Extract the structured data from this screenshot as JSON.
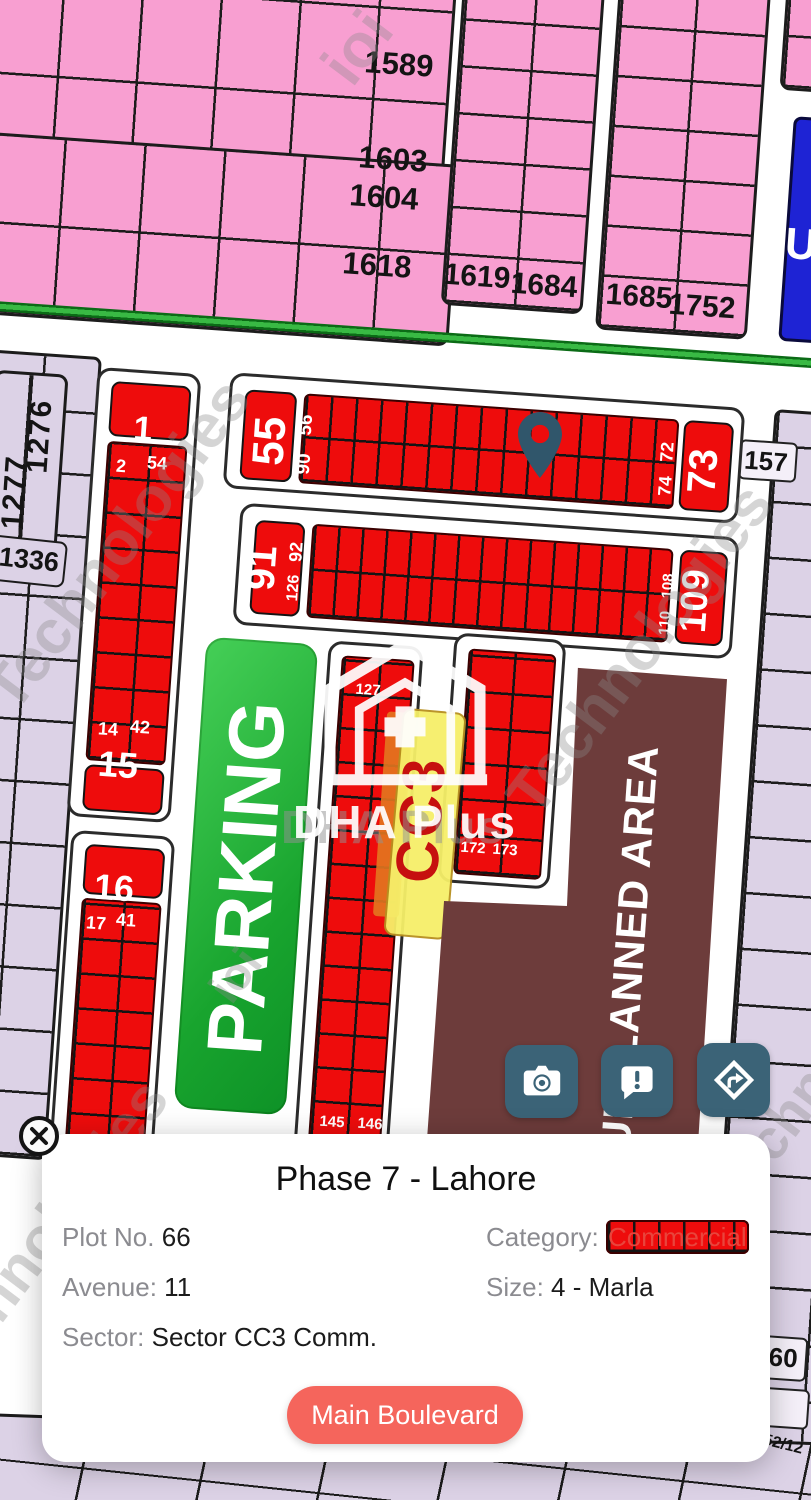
{
  "map": {
    "name": "DHA Phase 7 Lahore plot map",
    "labels": [
      {
        "t": "1589",
        "x": 399,
        "y": 64,
        "r": 4,
        "s": 31
      },
      {
        "t": "1603",
        "x": 393,
        "y": 159,
        "r": 4,
        "s": 31
      },
      {
        "t": "1604",
        "x": 384,
        "y": 197,
        "r": 4,
        "s": 31
      },
      {
        "t": "1618",
        "x": 377,
        "y": 265,
        "r": 4,
        "s": 31
      },
      {
        "t": "1619",
        "x": 477,
        "y": 277,
        "r": 4,
        "s": 30
      },
      {
        "t": "1684",
        "x": 544,
        "y": 286,
        "r": 4,
        "s": 30
      },
      {
        "t": "1685",
        "x": 639,
        "y": 297,
        "r": 4,
        "s": 30
      },
      {
        "t": "1752",
        "x": 702,
        "y": 307,
        "r": 4,
        "s": 30
      },
      {
        "t": "U",
        "x": 801,
        "y": 245,
        "r": 4,
        "s": 44,
        "c": "#ffffff"
      },
      {
        "t": "157",
        "x": 766,
        "y": 461,
        "r": 4,
        "s": 26
      },
      {
        "t": "160",
        "x": 776,
        "y": 1357,
        "r": 4,
        "s": 26
      },
      {
        "t": "52/12",
        "x": 783,
        "y": 1445,
        "r": 14,
        "s": 16
      },
      {
        "t": "1276",
        "x": 40,
        "y": 436,
        "r": -86,
        "s": 30,
        "ls": 2
      },
      {
        "t": "1277",
        "x": 15,
        "y": 492,
        "r": -86,
        "s": 30,
        "ls": 2
      },
      {
        "t": "1336",
        "x": 29,
        "y": 560,
        "r": 6,
        "s": 27
      },
      {
        "t": "55",
        "x": 270,
        "y": 441,
        "r": -86,
        "s": 44,
        "c": "#ffffff"
      },
      {
        "t": "56",
        "x": 306,
        "y": 425,
        "r": -86,
        "s": 19,
        "c": "#ffffff"
      },
      {
        "t": "90",
        "x": 304,
        "y": 464,
        "r": -86,
        "s": 19,
        "c": "#ffffff"
      },
      {
        "t": "72",
        "x": 667,
        "y": 452,
        "r": -86,
        "s": 18,
        "c": "#ffffff"
      },
      {
        "t": "74",
        "x": 665,
        "y": 486,
        "r": -86,
        "s": 18,
        "c": "#ffffff"
      },
      {
        "t": "73",
        "x": 703,
        "y": 471,
        "r": -86,
        "s": 40,
        "c": "#ffffff"
      },
      {
        "t": "91",
        "x": 262,
        "y": 568,
        "r": -86,
        "s": 40,
        "c": "#ffffff"
      },
      {
        "t": "92",
        "x": 296,
        "y": 552,
        "r": -86,
        "s": 18,
        "c": "#ffffff"
      },
      {
        "t": "126",
        "x": 294,
        "y": 588,
        "r": -86,
        "s": 16,
        "c": "#ffffff"
      },
      {
        "t": "108",
        "x": 668,
        "y": 586,
        "r": -86,
        "s": 15,
        "c": "#ffffff"
      },
      {
        "t": "110",
        "x": 665,
        "y": 623,
        "r": -86,
        "s": 15,
        "c": "#ffffff"
      },
      {
        "t": "109",
        "x": 695,
        "y": 601,
        "r": -86,
        "s": 38,
        "c": "#ffffff"
      },
      {
        "t": "1",
        "x": 143,
        "y": 429,
        "r": 4,
        "s": 34,
        "c": "#ffffff"
      },
      {
        "t": "2",
        "x": 121,
        "y": 466,
        "r": 4,
        "s": 18,
        "c": "#ffffff"
      },
      {
        "t": "54",
        "x": 157,
        "y": 463,
        "r": 4,
        "s": 18,
        "c": "#ffffff"
      },
      {
        "t": "14",
        "x": 108,
        "y": 729,
        "r": 4,
        "s": 18,
        "c": "#ffffff"
      },
      {
        "t": "42",
        "x": 140,
        "y": 727,
        "r": 4,
        "s": 18,
        "c": "#ffffff"
      },
      {
        "t": "15",
        "x": 118,
        "y": 765,
        "r": 4,
        "s": 36,
        "c": "#ffffff"
      },
      {
        "t": "16",
        "x": 114,
        "y": 888,
        "r": 4,
        "s": 36,
        "c": "#ffffff"
      },
      {
        "t": "17",
        "x": 96,
        "y": 923,
        "r": 4,
        "s": 18,
        "c": "#ffffff"
      },
      {
        "t": "41",
        "x": 126,
        "y": 920,
        "r": 4,
        "s": 18,
        "c": "#ffffff"
      },
      {
        "t": "127",
        "x": 368,
        "y": 690,
        "r": 4,
        "s": 15,
        "c": "#ffffff"
      },
      {
        "t": "145",
        "x": 332,
        "y": 1122,
        "r": 4,
        "s": 15,
        "c": "#ffffff"
      },
      {
        "t": "146",
        "x": 370,
        "y": 1124,
        "r": 4,
        "s": 15,
        "c": "#ffffff"
      },
      {
        "t": "172",
        "x": 473,
        "y": 848,
        "r": 4,
        "s": 15,
        "c": "#ffffff"
      },
      {
        "t": "173",
        "x": 505,
        "y": 850,
        "r": 4,
        "s": 15,
        "c": "#ffffff"
      },
      {
        "t": "PARKING",
        "x": 246,
        "y": 878,
        "r": -86,
        "s": 78,
        "c": "#ffffff",
        "name": "parking-label",
        "inter": false
      },
      {
        "t": "UNPLANNED AREA",
        "x": 630,
        "y": 948,
        "r": -86,
        "s": 42,
        "c": "#ffffff",
        "ls": 1,
        "name": "unplanned-area-label",
        "inter": false
      },
      {
        "t": "CC3",
        "x": 421,
        "y": 820,
        "r": -86,
        "s": 60,
        "c": "#c6100f",
        "ls": 2,
        "name": "sector-cc3-label",
        "inter": false
      }
    ],
    "watermarks": [
      {
        "t": "ioi",
        "x": 358,
        "y": 48,
        "s": 62
      },
      {
        "t": "Technologies",
        "x": 118,
        "y": 545,
        "s": 62
      },
      {
        "t": "Technologies",
        "x": 640,
        "y": 650,
        "s": 62
      },
      {
        "t": "Technologies",
        "x": 40,
        "y": 1240,
        "s": 60
      },
      {
        "t": "ioi",
        "x": 235,
        "y": 975,
        "s": 46
      },
      {
        "t": "Technologies",
        "x": 830,
        "y": 1060,
        "s": 56
      }
    ]
  },
  "watermark_logo": {
    "text": "DHA Plus"
  },
  "actions": {
    "buttons": [
      {
        "icon": "camera-icon"
      },
      {
        "icon": "report-icon"
      },
      {
        "icon": "directions-icon"
      }
    ]
  },
  "card": {
    "title": "Phase 7 - Lahore",
    "fields": {
      "plot_label": "Plot No.",
      "plot_value": "66",
      "category_label": "Category:",
      "category_value": "Commercial",
      "avenue_label": "Avenue:",
      "avenue_value": "11",
      "size_label": "Size:",
      "size_value": "4 - Marla",
      "sector_label": "Sector:",
      "sector_value": "Sector CC3 Comm."
    },
    "road_button": "Main Boulevard"
  },
  "colors": {
    "residential_pink": "#f89fd1",
    "allotted_lavender": "#dcd2e6",
    "commercial_red": "#ee0c0c",
    "parking_green": "#18a42e",
    "unplanned_brown": "#6d3c3b",
    "reserved_blue": "#1e23d4",
    "action_button": "#3b6377",
    "pin": "#30566b",
    "road_button": "#f5655c",
    "category_text": "#e8453c"
  }
}
